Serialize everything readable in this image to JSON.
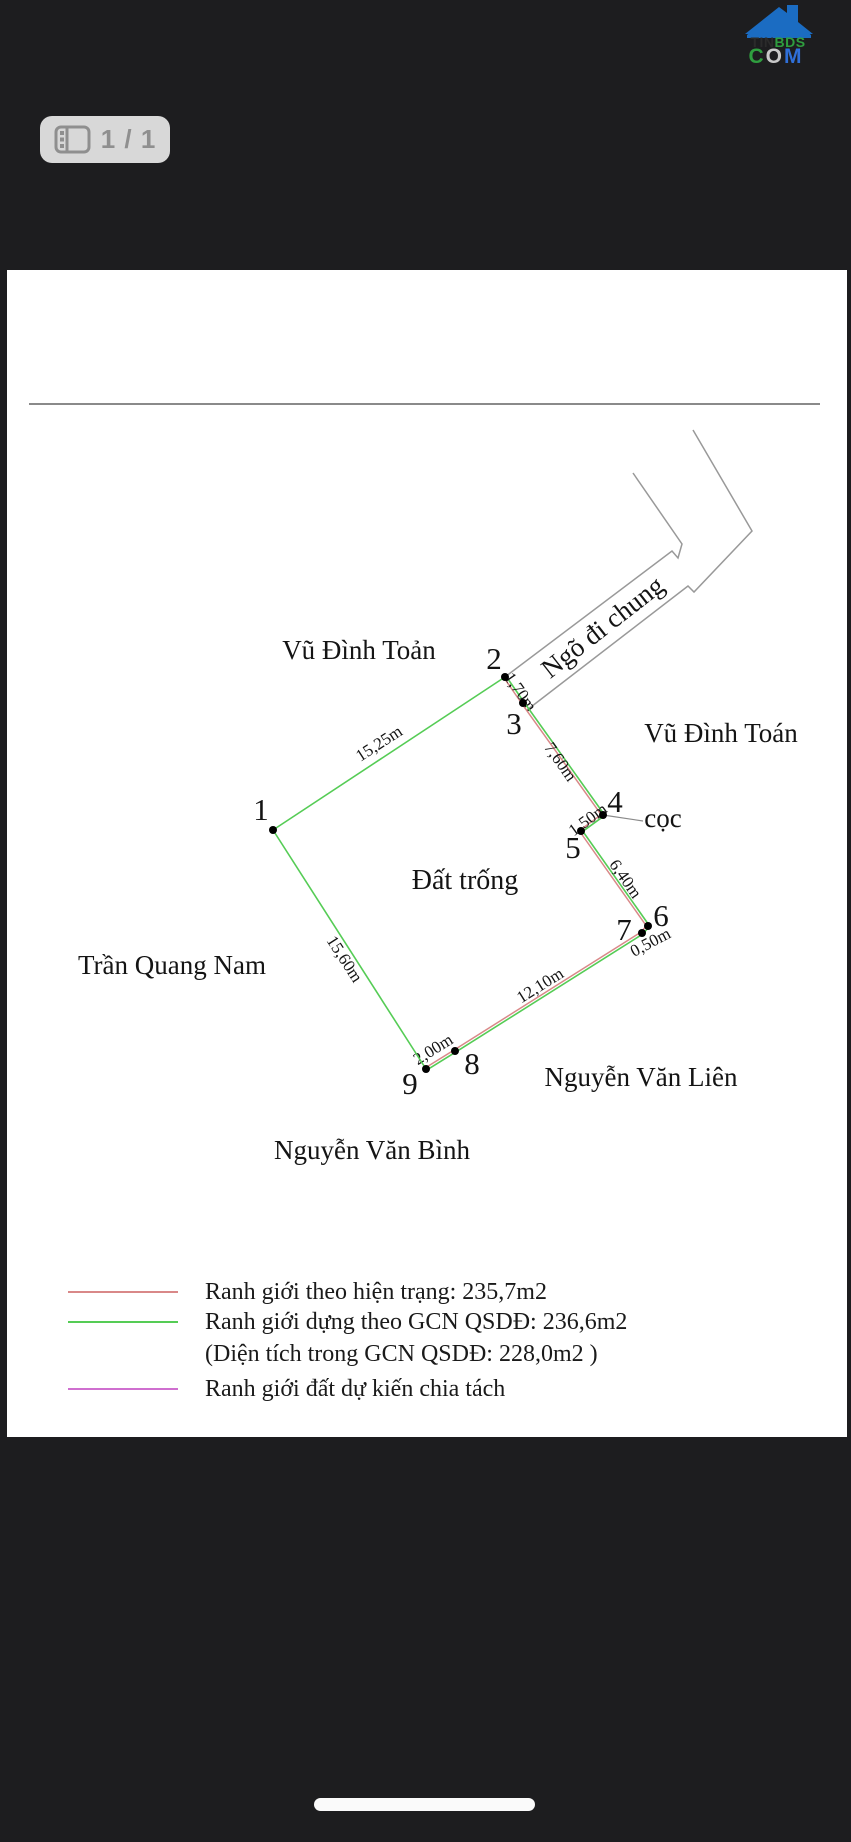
{
  "logo": {
    "house_color": "#1b6cc2",
    "segments_top": [
      {
        "text": "TIN",
        "color": "#2b2b2b"
      },
      {
        "text": "BDS",
        "color": "#2f9e3f"
      }
    ],
    "segments_bottom": [
      {
        "text": "C",
        "color": "#2f9e3f"
      },
      {
        "text": "O",
        "color": "#c9c9c9"
      },
      {
        "text": "M",
        "color": "#2f6fd8"
      }
    ]
  },
  "pager": {
    "label": "1 / 1"
  },
  "colors": {
    "app_bg": "#1d1d1f",
    "page_bg": "#ffffff",
    "boundary_current": "#d98888",
    "boundary_gcn": "#55cc55",
    "boundary_split": "#cf6fcf",
    "road_line": "#999999",
    "rule_line": "#8a8a8a"
  },
  "legend": [
    {
      "swatch": "boundary_current",
      "text": "Ranh giới theo hiện trạng: 235,7m2"
    },
    {
      "swatch": "boundary_gcn",
      "text": "Ranh giới dựng theo GCN QSDĐ: 236,6m2"
    },
    {
      "swatch": "none",
      "text": "(Diện tích trong GCN QSDĐ: 228,0m2 )"
    },
    {
      "swatch": "boundary_split",
      "text": "Ranh giới đất dự kiến chia tách"
    }
  ],
  "diagram": {
    "rule_line": {
      "x1": 22,
      "y1": 134,
      "x2": 813,
      "y2": 134
    },
    "road": {
      "label": "Ngõ đi chung",
      "label_x": 601,
      "label_y": 364,
      "label_rotate": -38,
      "paths": [
        "M498,407 L665,281 L671,288 L675,274 L626,203",
        "M520,440 L681,316 L687,322 L745,261 L686,160"
      ]
    },
    "leader_line": {
      "x1": 596,
      "y1": 545,
      "x2": 636,
      "y2": 551
    },
    "points": [
      {
        "id": "1",
        "x": 266,
        "y": 560,
        "lx": 254,
        "ly": 550
      },
      {
        "id": "2",
        "x": 498,
        "y": 407,
        "lx": 487,
        "ly": 399
      },
      {
        "id": "3",
        "x": 516,
        "y": 433,
        "lx": 507,
        "ly": 464
      },
      {
        "id": "4",
        "x": 596,
        "y": 545,
        "lx": 608,
        "ly": 542
      },
      {
        "id": "5",
        "x": 574,
        "y": 561,
        "lx": 566,
        "ly": 588
      },
      {
        "id": "6",
        "x": 641,
        "y": 656,
        "lx": 654,
        "ly": 656
      },
      {
        "id": "7",
        "x": 635,
        "y": 663,
        "lx": 617,
        "ly": 670
      },
      {
        "id": "8",
        "x": 448,
        "y": 781,
        "lx": 465,
        "ly": 804
      },
      {
        "id": "9",
        "x": 419,
        "y": 799,
        "lx": 403,
        "ly": 824
      }
    ],
    "edges": [
      {
        "from": "1",
        "to": "2",
        "length": "15,25m",
        "style": "gcn",
        "lx": 375,
        "ly": 478,
        "rot": -33
      },
      {
        "from": "2",
        "to": "3",
        "length": "1,70m",
        "style": "both",
        "lx": 509,
        "ly": 425,
        "rot": 55
      },
      {
        "from": "3",
        "to": "4",
        "length": "7,60m",
        "style": "both",
        "lx": 549,
        "ly": 495,
        "rot": 55
      },
      {
        "from": "4",
        "to": "5",
        "length": "1,50m",
        "style": "both",
        "lx": 584,
        "ly": 554,
        "rot": -36
      },
      {
        "from": "5",
        "to": "6",
        "length": "6,40m",
        "style": "both",
        "lx": 614,
        "ly": 612,
        "rot": 55
      },
      {
        "from": "6",
        "to": "7",
        "length": "0,50m",
        "style": "both",
        "lx": 646,
        "ly": 677,
        "rot": -28
      },
      {
        "from": "7",
        "to": "8",
        "length": "12,10m",
        "style": "both",
        "lx": 536,
        "ly": 720,
        "rot": -32
      },
      {
        "from": "8",
        "to": "9",
        "length": "2,00m",
        "style": "both",
        "lx": 429,
        "ly": 784,
        "rot": -32
      },
      {
        "from": "9",
        "to": "1",
        "length": "15,60m",
        "style": "gcn",
        "lx": 333,
        "ly": 692,
        "rot": 57
      }
    ],
    "area_label": {
      "text": "Đất trống",
      "x": 458,
      "y": 619
    },
    "neighbors": [
      {
        "text": "Vũ Đình Toản",
        "x": 352,
        "y": 389
      },
      {
        "text": "Vũ Đình Toán",
        "x": 714,
        "y": 472
      },
      {
        "text": "cọc",
        "x": 656,
        "y": 557
      },
      {
        "text": "Trần Quang Nam",
        "x": 165,
        "y": 704
      },
      {
        "text": "Nguyễn Văn Liên",
        "x": 634,
        "y": 816
      },
      {
        "text": "Nguyễn Văn Bình",
        "x": 365,
        "y": 889
      }
    ]
  }
}
